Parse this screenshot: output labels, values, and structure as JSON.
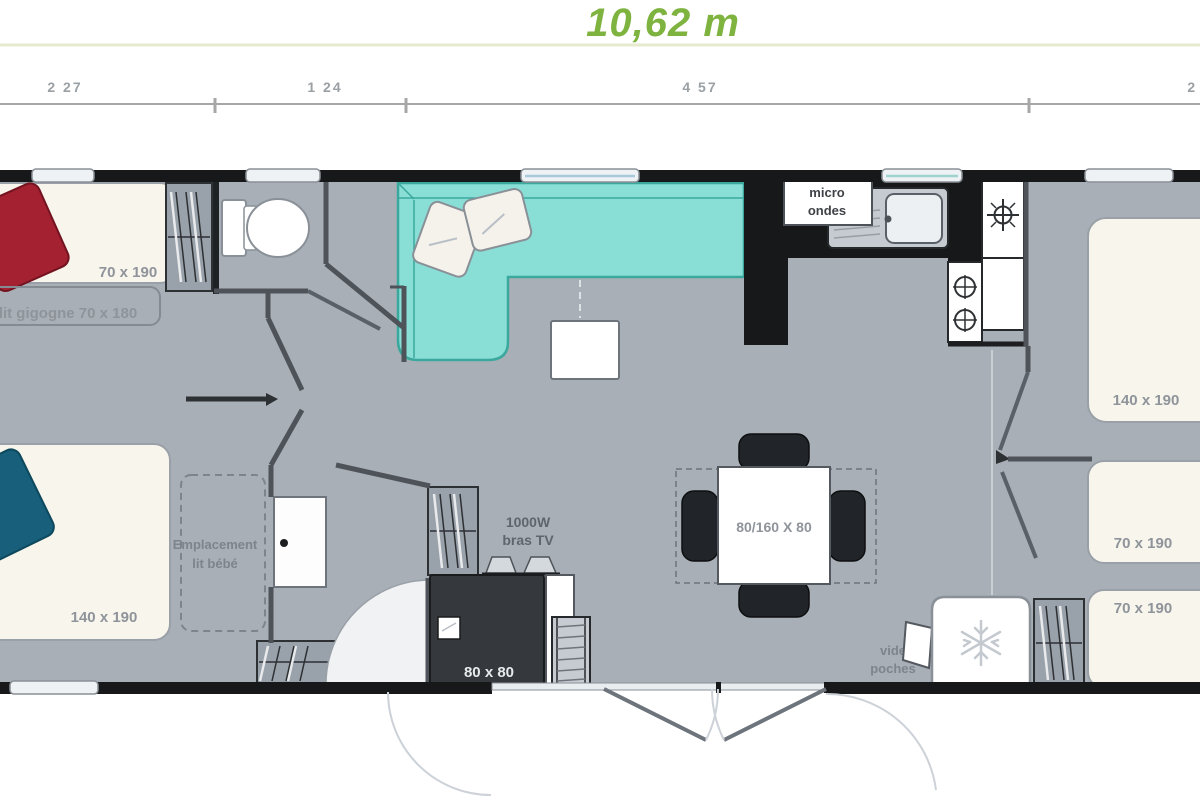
{
  "header": {
    "title": "10,62 m",
    "dimensions": {
      "d1": "2 27",
      "d2": "1 24",
      "d3": "4 57",
      "d4": "2 54"
    }
  },
  "labels": {
    "bed_single_top": "70 x 190",
    "trundle_bed": "lit gigogne 70 x 180",
    "bed_double_left": "140 x 190",
    "baby_bed_line1": "Emplacement",
    "baby_bed_line2": "lit bébé",
    "microwave_line1": "micro",
    "microwave_line2": "ondes",
    "tv_bracket_line1": "1000W",
    "tv_bracket_line2": "bras TV",
    "shower": "80 x 80",
    "dining_table": "80/160 X 80",
    "vide_poches_line1": "vide",
    "vide_poches_line2": "poches",
    "bed_double_right": "140 x 190",
    "bed_single_right1": "70 x 190",
    "bed_single_right2": "70 x 190"
  },
  "colors": {
    "title_green": "#7eb33f",
    "separator": "#e7ebcd",
    "floor": "#a9afb7",
    "wall_black": "#17181a",
    "bed_cream": "#f7f5ec",
    "sofa_teal": "#89ded6",
    "sofa_edge": "#3aa89d",
    "pillow_red": "#a32130",
    "pillow_navy": "#175f7a"
  }
}
